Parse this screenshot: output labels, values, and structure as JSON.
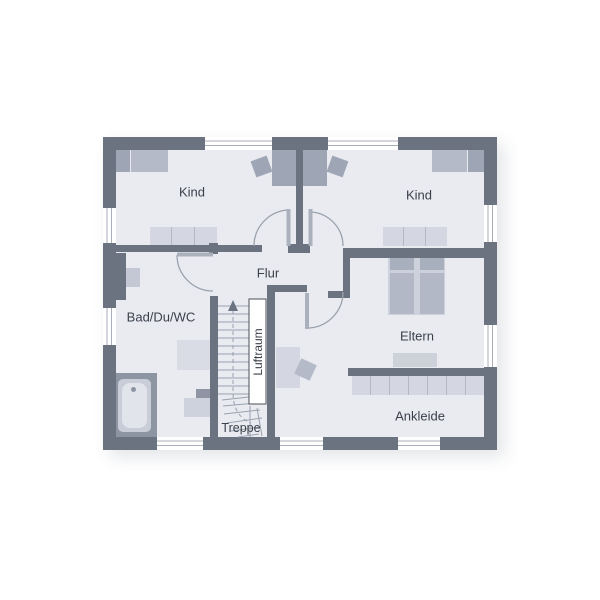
{
  "plan": {
    "type": "floor-plan",
    "rooms": {
      "kind_left": {
        "label": "Kind"
      },
      "kind_right": {
        "label": "Kind"
      },
      "flur": {
        "label": "Flur"
      },
      "bad": {
        "label": "Bad/Du/WC"
      },
      "eltern": {
        "label": "Eltern"
      },
      "ankleide": {
        "label": "Ankleide"
      },
      "treppe": {
        "label": "Treppe"
      },
      "luftraum": {
        "label": "Luftraum"
      }
    },
    "furniture": [
      "bed-kind-left",
      "desk-kind-left",
      "chair-kind-left",
      "dresser-kind-left",
      "bed-kind-right",
      "desk-kind-right",
      "chair-kind-right",
      "dresser-kind-right",
      "double-bed-eltern",
      "bench-eltern",
      "wardrobe-ankleide",
      "desk-hall",
      "chair-hall",
      "bathtub",
      "shower",
      "wc",
      "sink",
      "stairs"
    ],
    "colors": {
      "bg": "#ffffff",
      "wall": "#6b7380",
      "floor": "#e9ebf1",
      "furn-light": "#d4d7e1",
      "furn-medium": "#b4bac7",
      "furn-dark": "#9ea6b5",
      "line": "#9aa2ae",
      "text": "#3b404b"
    }
  }
}
